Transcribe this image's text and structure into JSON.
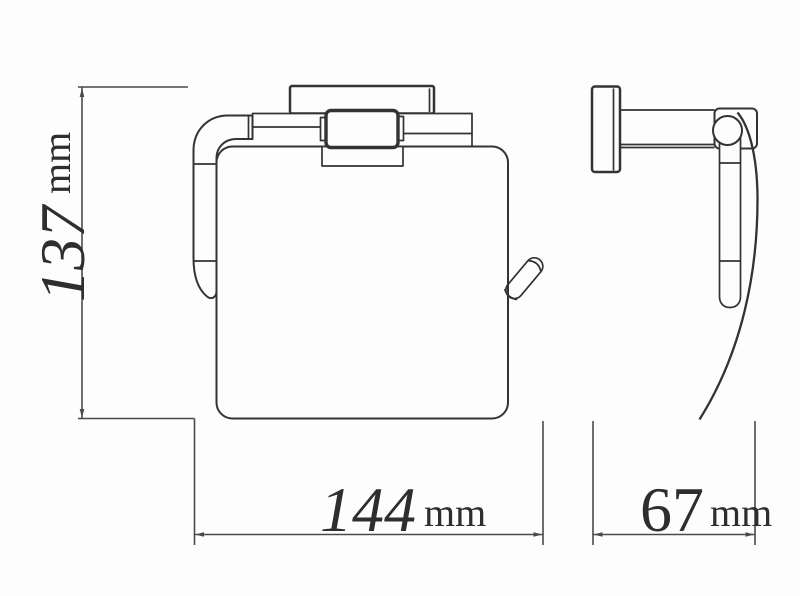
{
  "dimensions": {
    "height": {
      "value": "137",
      "unit": "mm"
    },
    "width": {
      "value": "144",
      "unit": "mm"
    },
    "depth": {
      "value": "67",
      "unit": "mm"
    }
  },
  "style": {
    "line_color": "#333333",
    "dimension_color": "#4a4a4a",
    "background": "#fdfdfd"
  }
}
